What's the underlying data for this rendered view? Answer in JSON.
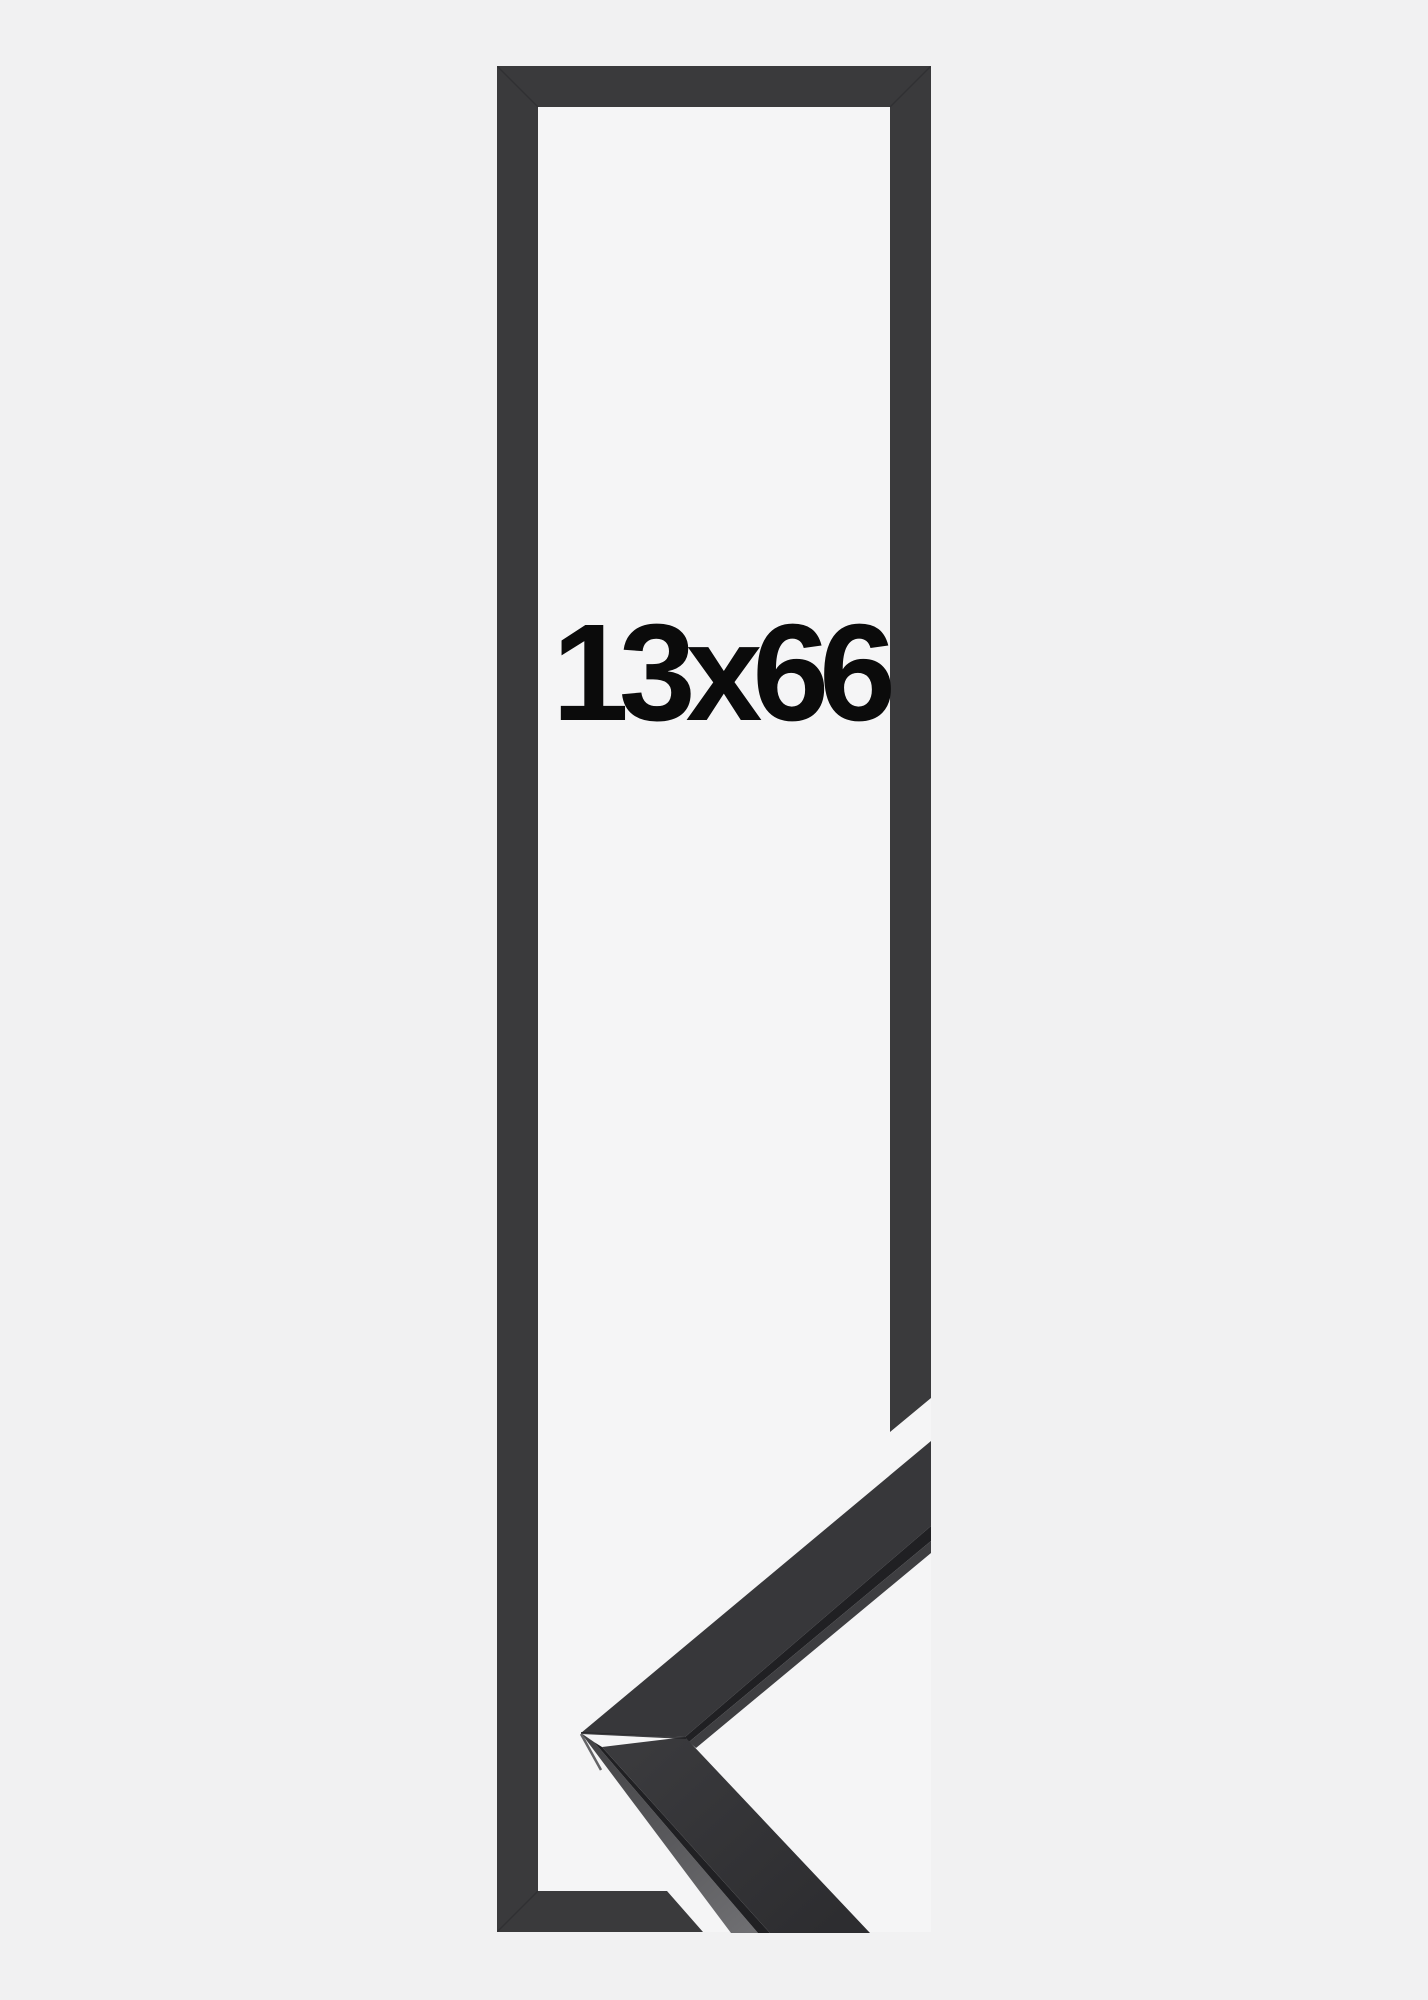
{
  "product": {
    "size_label": "13x66"
  },
  "frame": {
    "type": "corner-sample-size-preview",
    "background_color": "#f1f1f2",
    "inner_background_color": "#f5f5f6",
    "bar_color": "#3a3a3c",
    "seam_color": "#26262a"
  },
  "sample": {
    "top_face_color": "#37373a",
    "edge_color": "#202023",
    "underside_color": "#3e3e41",
    "lit_face_color_start": "#434346",
    "lit_face_color_end": "#6f6f72",
    "side_face_color_start": "#3a3a3d",
    "side_face_color_end": "#2d2d30",
    "highlight_color": "#646467"
  }
}
